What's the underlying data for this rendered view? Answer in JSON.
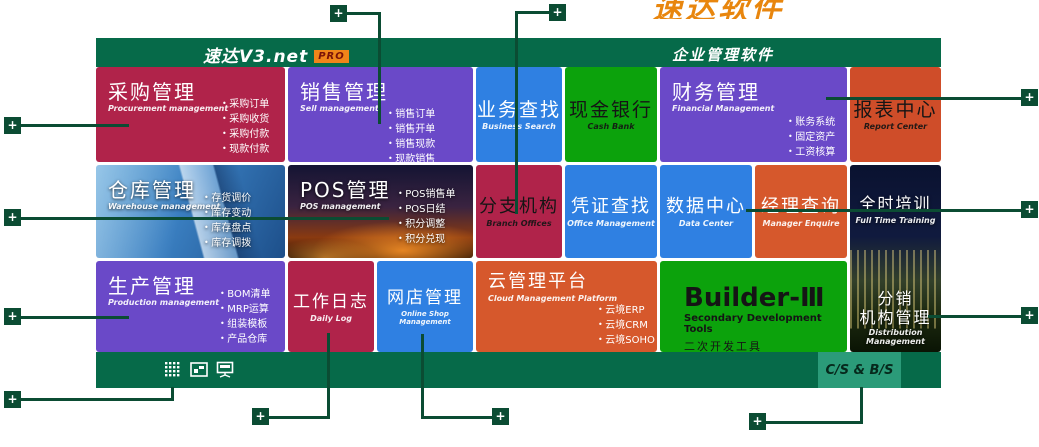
{
  "colors": {
    "brand_green": "#066a49",
    "callout_green": "#0b4c33",
    "badge_green": "#2b9b79",
    "crimson": "#b0234a",
    "purple": "#6a49c8",
    "blue": "#2f80e2",
    "tile_green": "#0ca20c",
    "orange": "#d6582c",
    "orange_dark": "#cf4d29",
    "pro_badge_orange": "#f08519",
    "watermark_orange": "#e8860e"
  },
  "watermark": {
    "text": "速达软件"
  },
  "header": {
    "logo": "速达V3.net",
    "pro_badge": "PRO",
    "right_title": "企业管理软件"
  },
  "tiles": {
    "caigou": {
      "title": "采购管理",
      "subtitle": "Procurement management",
      "bullets": [
        "采购订单",
        "采购收货",
        "采购付款",
        "现款付款"
      ]
    },
    "xiaoshou": {
      "title": "销售管理",
      "subtitle": "Sell management",
      "bullets": [
        "销售订单",
        "销售开单",
        "销售现款",
        "现款销售"
      ]
    },
    "yewu": {
      "title": "业务查找",
      "subtitle": "Business Search"
    },
    "xianjin": {
      "title": "现金银行",
      "subtitle": "Cash Bank"
    },
    "caiwu": {
      "title": "财务管理",
      "subtitle": "Financial Management",
      "bullets": [
        "账务系统",
        "固定资产",
        "工资核算"
      ]
    },
    "baobiao": {
      "title": "报表中心",
      "subtitle": "Report Center"
    },
    "cangku": {
      "title": "仓库管理",
      "subtitle": "Warehouse management",
      "bullets": [
        "存货调价",
        "库存变动",
        "库存盘点",
        "库存调拨"
      ]
    },
    "pos": {
      "title": "POS管理",
      "subtitle": "POS management",
      "bullets": [
        "POS销售单",
        "POS日结",
        "积分调整",
        "积分兑现"
      ]
    },
    "fenzhi": {
      "title": "分支机构",
      "subtitle": "Branch Offices"
    },
    "pingzheng": {
      "title": "凭证查找",
      "subtitle": "Office Management"
    },
    "shuju": {
      "title": "数据中心",
      "subtitle": "Data Center"
    },
    "jingli": {
      "title": "经理查询",
      "subtitle": "Manager Enquire"
    },
    "quanshi": {
      "title": "全时培训",
      "subtitle": "Full Time Training"
    },
    "shengchan": {
      "title": "生产管理",
      "subtitle": "Production management",
      "bullets": [
        "BOM清单",
        "MRP运算",
        "组装模板",
        "产品仓库"
      ]
    },
    "gongzuo": {
      "title": "工作日志",
      "subtitle": "Daily Log"
    },
    "wangdian": {
      "title": "网店管理",
      "subtitle": "Online Shop Management"
    },
    "yun": {
      "title": "云管理平台",
      "subtitle": "Cloud Management Platform",
      "bullets": [
        "云境ERP",
        "云境CRM",
        "云境SOHO"
      ]
    },
    "builder": {
      "title": "Builder-Ⅲ",
      "subtitle": "Secondary Development Tools",
      "subtitle2": "二次开发工具"
    },
    "fenxiao": {
      "title_line1": "分销",
      "title_line2": "机构管理",
      "subtitle": "Distribution Management"
    }
  },
  "footer": {
    "cs_bs_label": "C/S & B/S",
    "icons": [
      "app-grid-icon",
      "report-chart-icon",
      "network-monitor-icon"
    ]
  },
  "callouts": {
    "plus_label": "+"
  }
}
